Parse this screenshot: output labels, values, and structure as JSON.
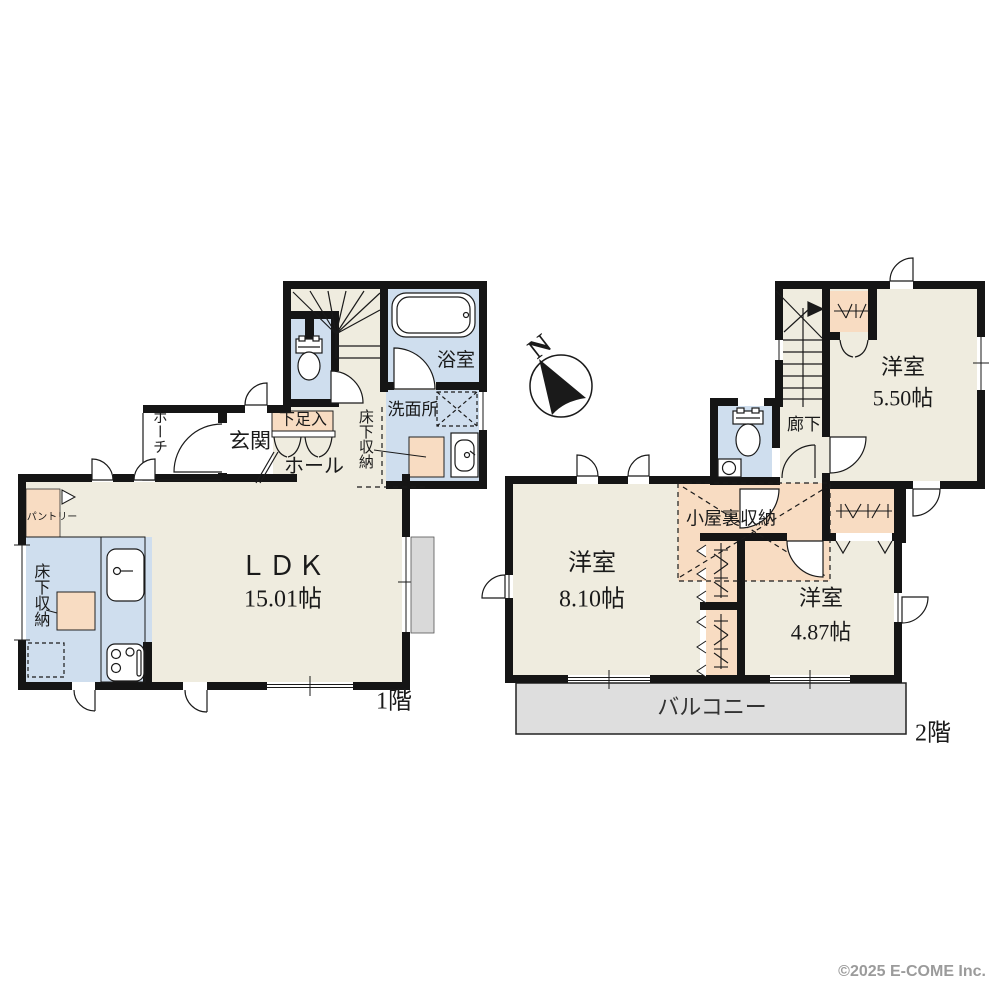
{
  "floor1": {
    "label": "1階",
    "ldk": {
      "name": "ＬＤＫ",
      "size": "15.01帖"
    },
    "porch": "ポーチ",
    "genkan": "玄関",
    "shoe_cabinet": "下足入",
    "hall": "ホール",
    "bathroom": "浴室",
    "washroom": "洗面所",
    "underfloor_storage_hall": "床下収納",
    "underfloor_storage_kitchen": "床下収納",
    "pantry": "パントリー"
  },
  "floor2": {
    "label": "2階",
    "corridor": "廊下",
    "room_a": {
      "name": "洋室",
      "size": "5.50帖"
    },
    "room_b": {
      "name": "洋室",
      "size": "8.10帖"
    },
    "room_c": {
      "name": "洋室",
      "size": "4.87帖"
    },
    "attic_storage": "小屋裏収納",
    "balcony": "バルコニー"
  },
  "compass": {
    "north": "N"
  },
  "footer": {
    "copyright": "©2025 E-COME Inc."
  },
  "colors": {
    "wall": "#151515",
    "floor_beige": "#efecdf",
    "wet_blue": "#cfdeee",
    "storage_peach": "#f8dcc2",
    "balcony_gray": "#dedede",
    "shutter_gray": "#d9d9d9"
  }
}
